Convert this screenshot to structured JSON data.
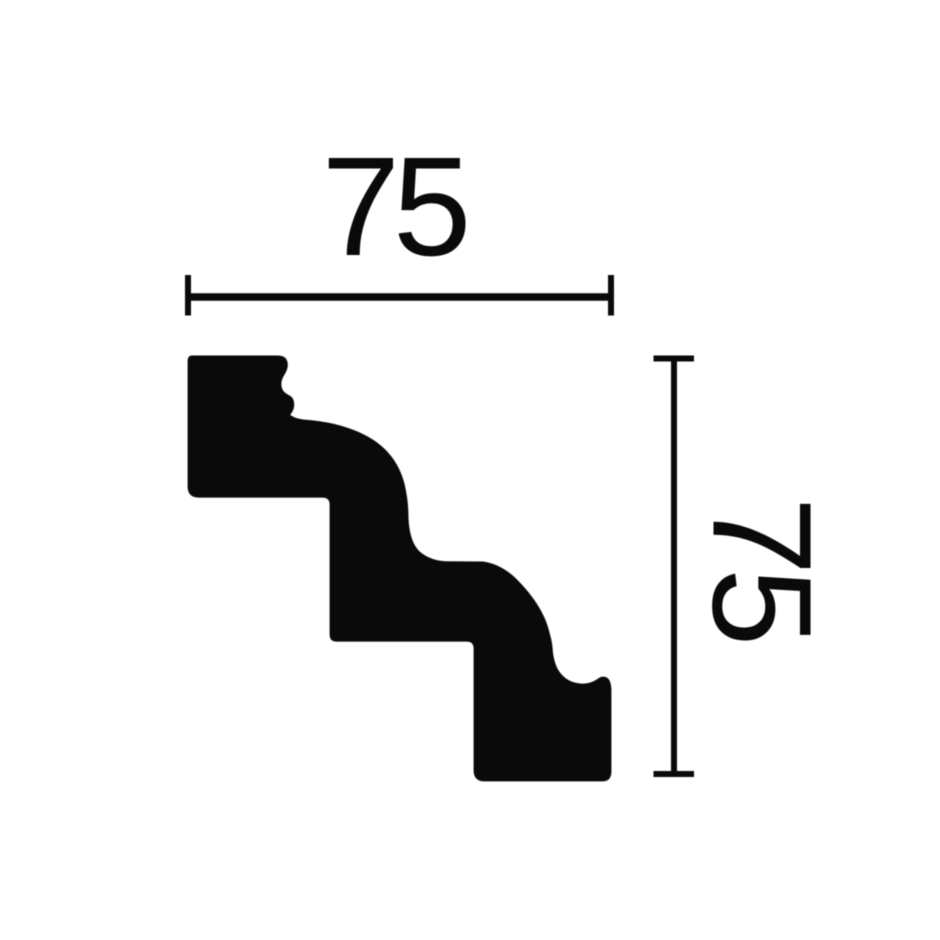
{
  "colors": {
    "ink": "#0a0a0a",
    "background": "#ffffff"
  },
  "diagram": {
    "dimensions": {
      "width": {
        "label": "75"
      },
      "height": {
        "label": "75"
      }
    }
  }
}
